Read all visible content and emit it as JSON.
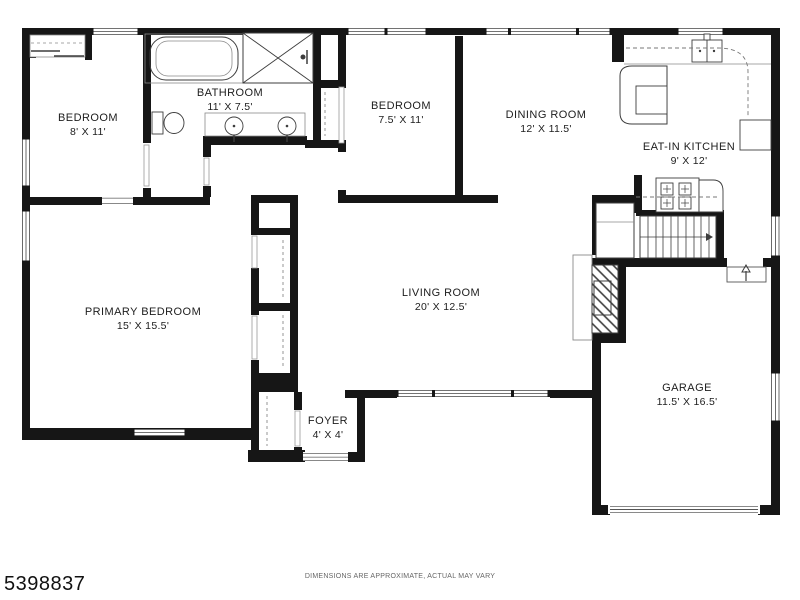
{
  "rooms": [
    {
      "name": "BEDROOM",
      "dims": "8' X 11'"
    },
    {
      "name": "BATHROOM",
      "dims": "11' X 7.5'"
    },
    {
      "name": "BEDROOM",
      "dims": "7.5' X 11'"
    },
    {
      "name": "DINING ROOM",
      "dims": "12' X 11.5'"
    },
    {
      "name": "EAT-IN KITCHEN",
      "dims": "9' X 12'"
    },
    {
      "name": "PRIMARY BEDROOM",
      "dims": "15' X 15.5'"
    },
    {
      "name": "LIVING ROOM",
      "dims": "20' X 12.5'"
    },
    {
      "name": "FOYER",
      "dims": "4' X 4'"
    },
    {
      "name": "GARAGE",
      "dims": "11.5' X 16.5'"
    }
  ],
  "footer": {
    "listing_id": "5398837",
    "disclaimer": "DIMENSIONS ARE APPROXIMATE, ACTUAL MAY VARY"
  },
  "colors": {
    "wall": "#161616",
    "fixture_line": "#3d3d3d",
    "light_line": "#8a8a8a",
    "background": "#ffffff",
    "text": "#1d1d1d"
  }
}
